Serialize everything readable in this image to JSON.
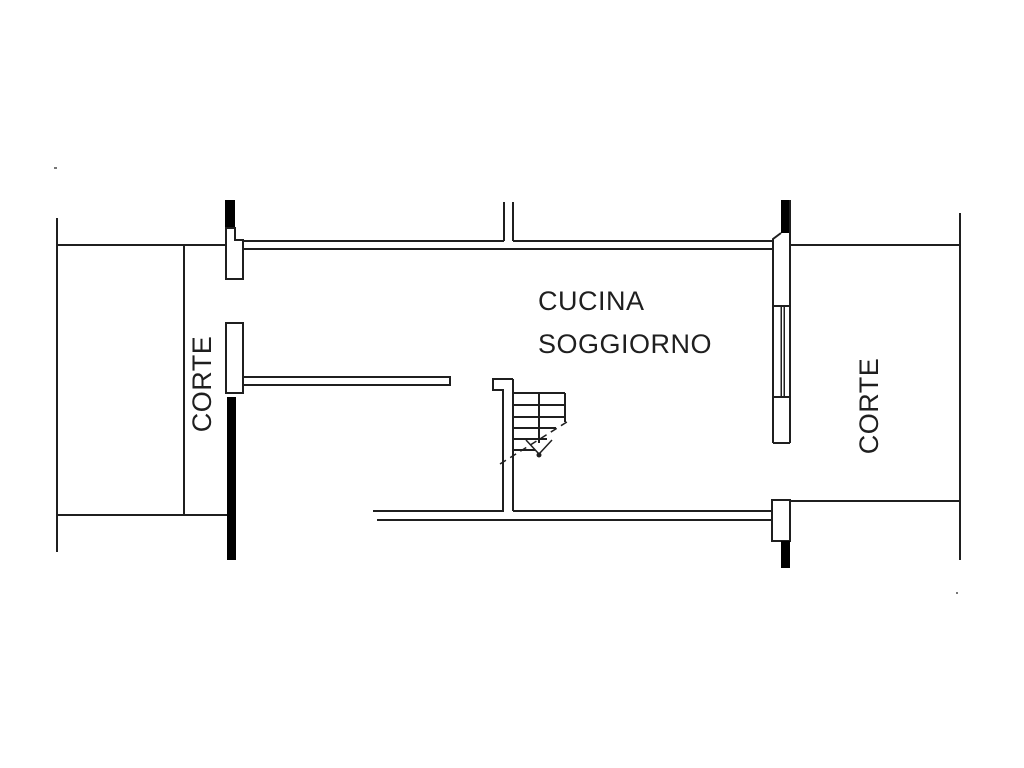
{
  "page": {
    "background_color": "#ffffff",
    "line_color": "#1f1f1f",
    "text_color": "#1f1f1f"
  },
  "floor_plan": {
    "rooms": [
      {
        "name": "cucina-soggiorno",
        "label_line1": "CUCINA",
        "label_line2": "SOGGIORNO",
        "label_orientation": "horizontal"
      },
      {
        "name": "corte-left",
        "label": "CORTE",
        "label_orientation": "vertical-bottom-to-top"
      },
      {
        "name": "corte-right",
        "label": "CORTE",
        "label_orientation": "vertical-bottom-to-top"
      }
    ],
    "features": [
      "staircase-symbol-with-dashed-direction-arrow",
      "door-openings-with-white-jambs",
      "window-symbol-in-right-wall",
      "solid-black-wall-segments",
      "double-line-walls"
    ]
  }
}
